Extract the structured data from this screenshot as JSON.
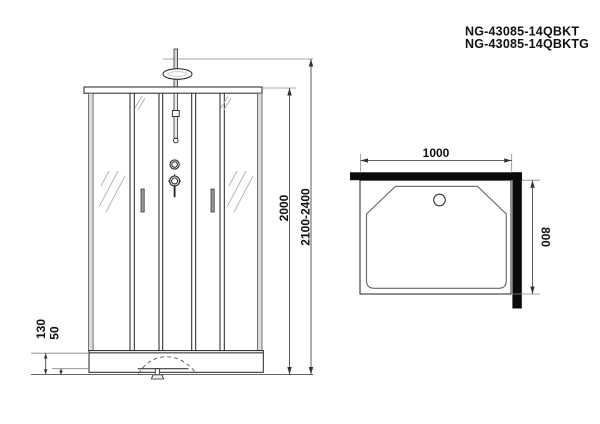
{
  "title": {
    "model_1": "NG-43085-14QBKT",
    "model_2": "NG-43085-14QBKTG"
  },
  "front_view": {
    "height_glass": "2000",
    "height_total": "2100-2400",
    "tray_height": "130",
    "tray_skirt": "50"
  },
  "top_view": {
    "width": "1000",
    "depth": "800"
  },
  "colors": {
    "line": "#222222",
    "wall": "#0a0a0a",
    "dim": "#444444",
    "hatch": "#b5b5b5"
  }
}
